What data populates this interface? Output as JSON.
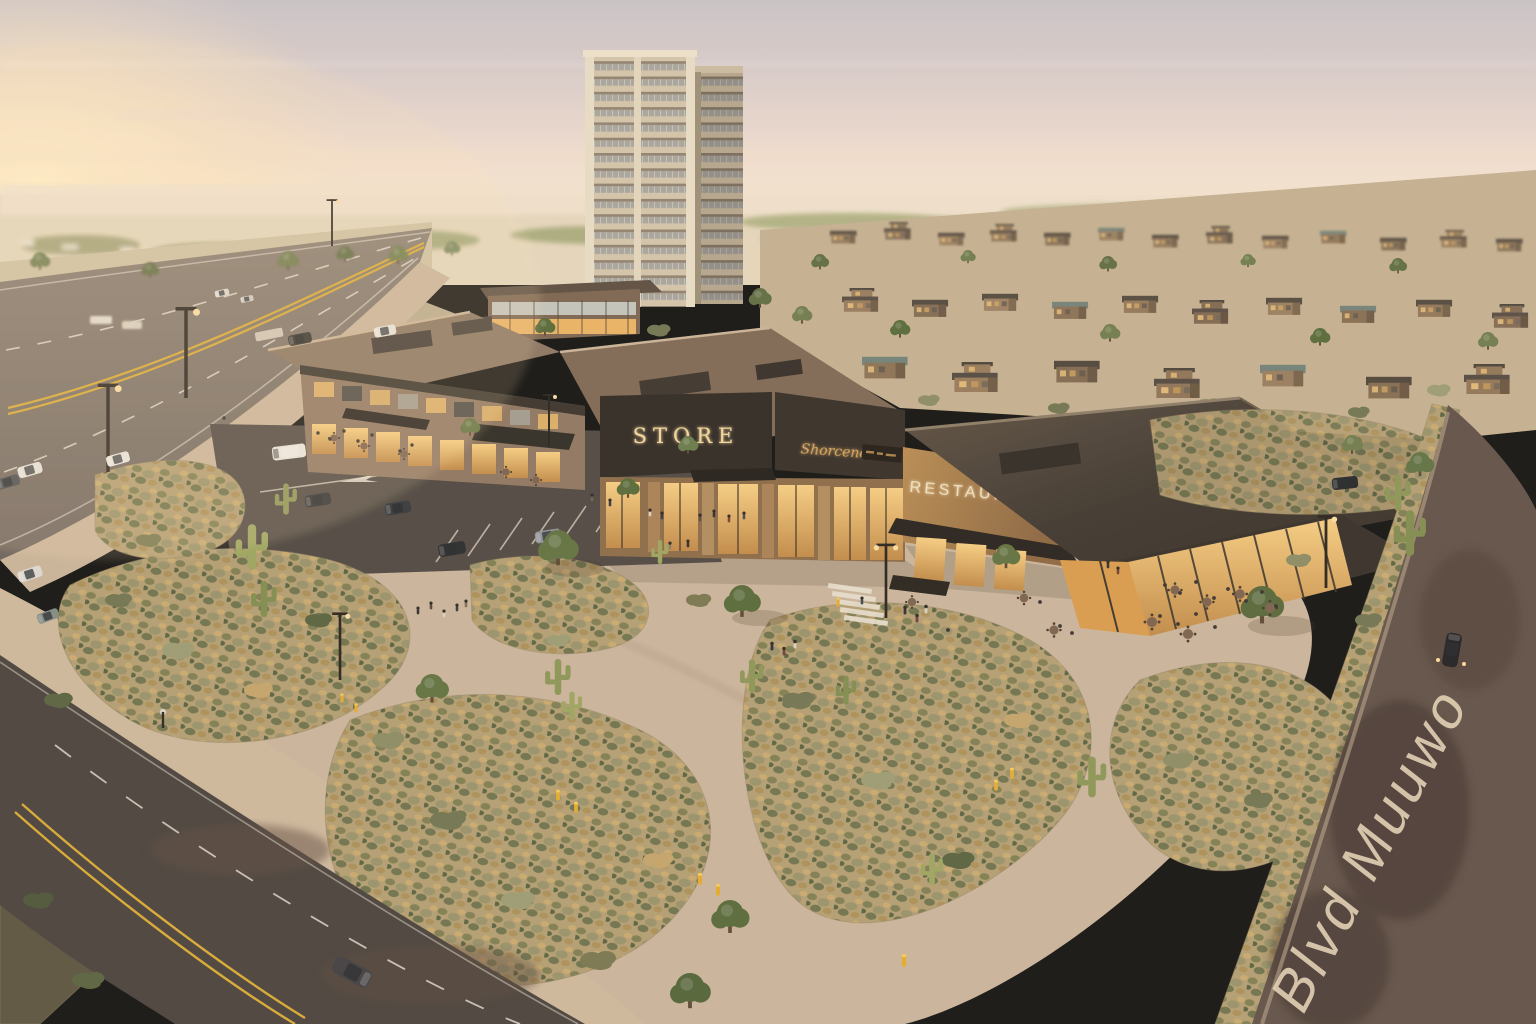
{
  "scene": {
    "description": "Aerial sunset rendering of a desert mixed-use development: retail plaza, residential high-rise tower, single-family neighborhood, desert landscaping and boulevards",
    "signs": {
      "store": "STORE",
      "tenant_script": "Shorcenee",
      "restaurant": "RESTAURANT"
    },
    "road": {
      "pavement_text": "Blvd Muuwo"
    },
    "tower": {
      "floors": "16"
    },
    "palette": {
      "sky_top": "#c8c2c8",
      "sun_glow": "#ffedc6",
      "horizon_haze": "#f0e1cf",
      "concrete": "#c9b49c",
      "asphalt": "#56504b",
      "dark_roof": "#3a332d",
      "stone": "#a87f54",
      "warm_glass": "#f2c178",
      "bollard_yellow": "#e2a92f",
      "lane_yellow": "#d8a833",
      "desert_scrub": "#b29d72"
    }
  }
}
